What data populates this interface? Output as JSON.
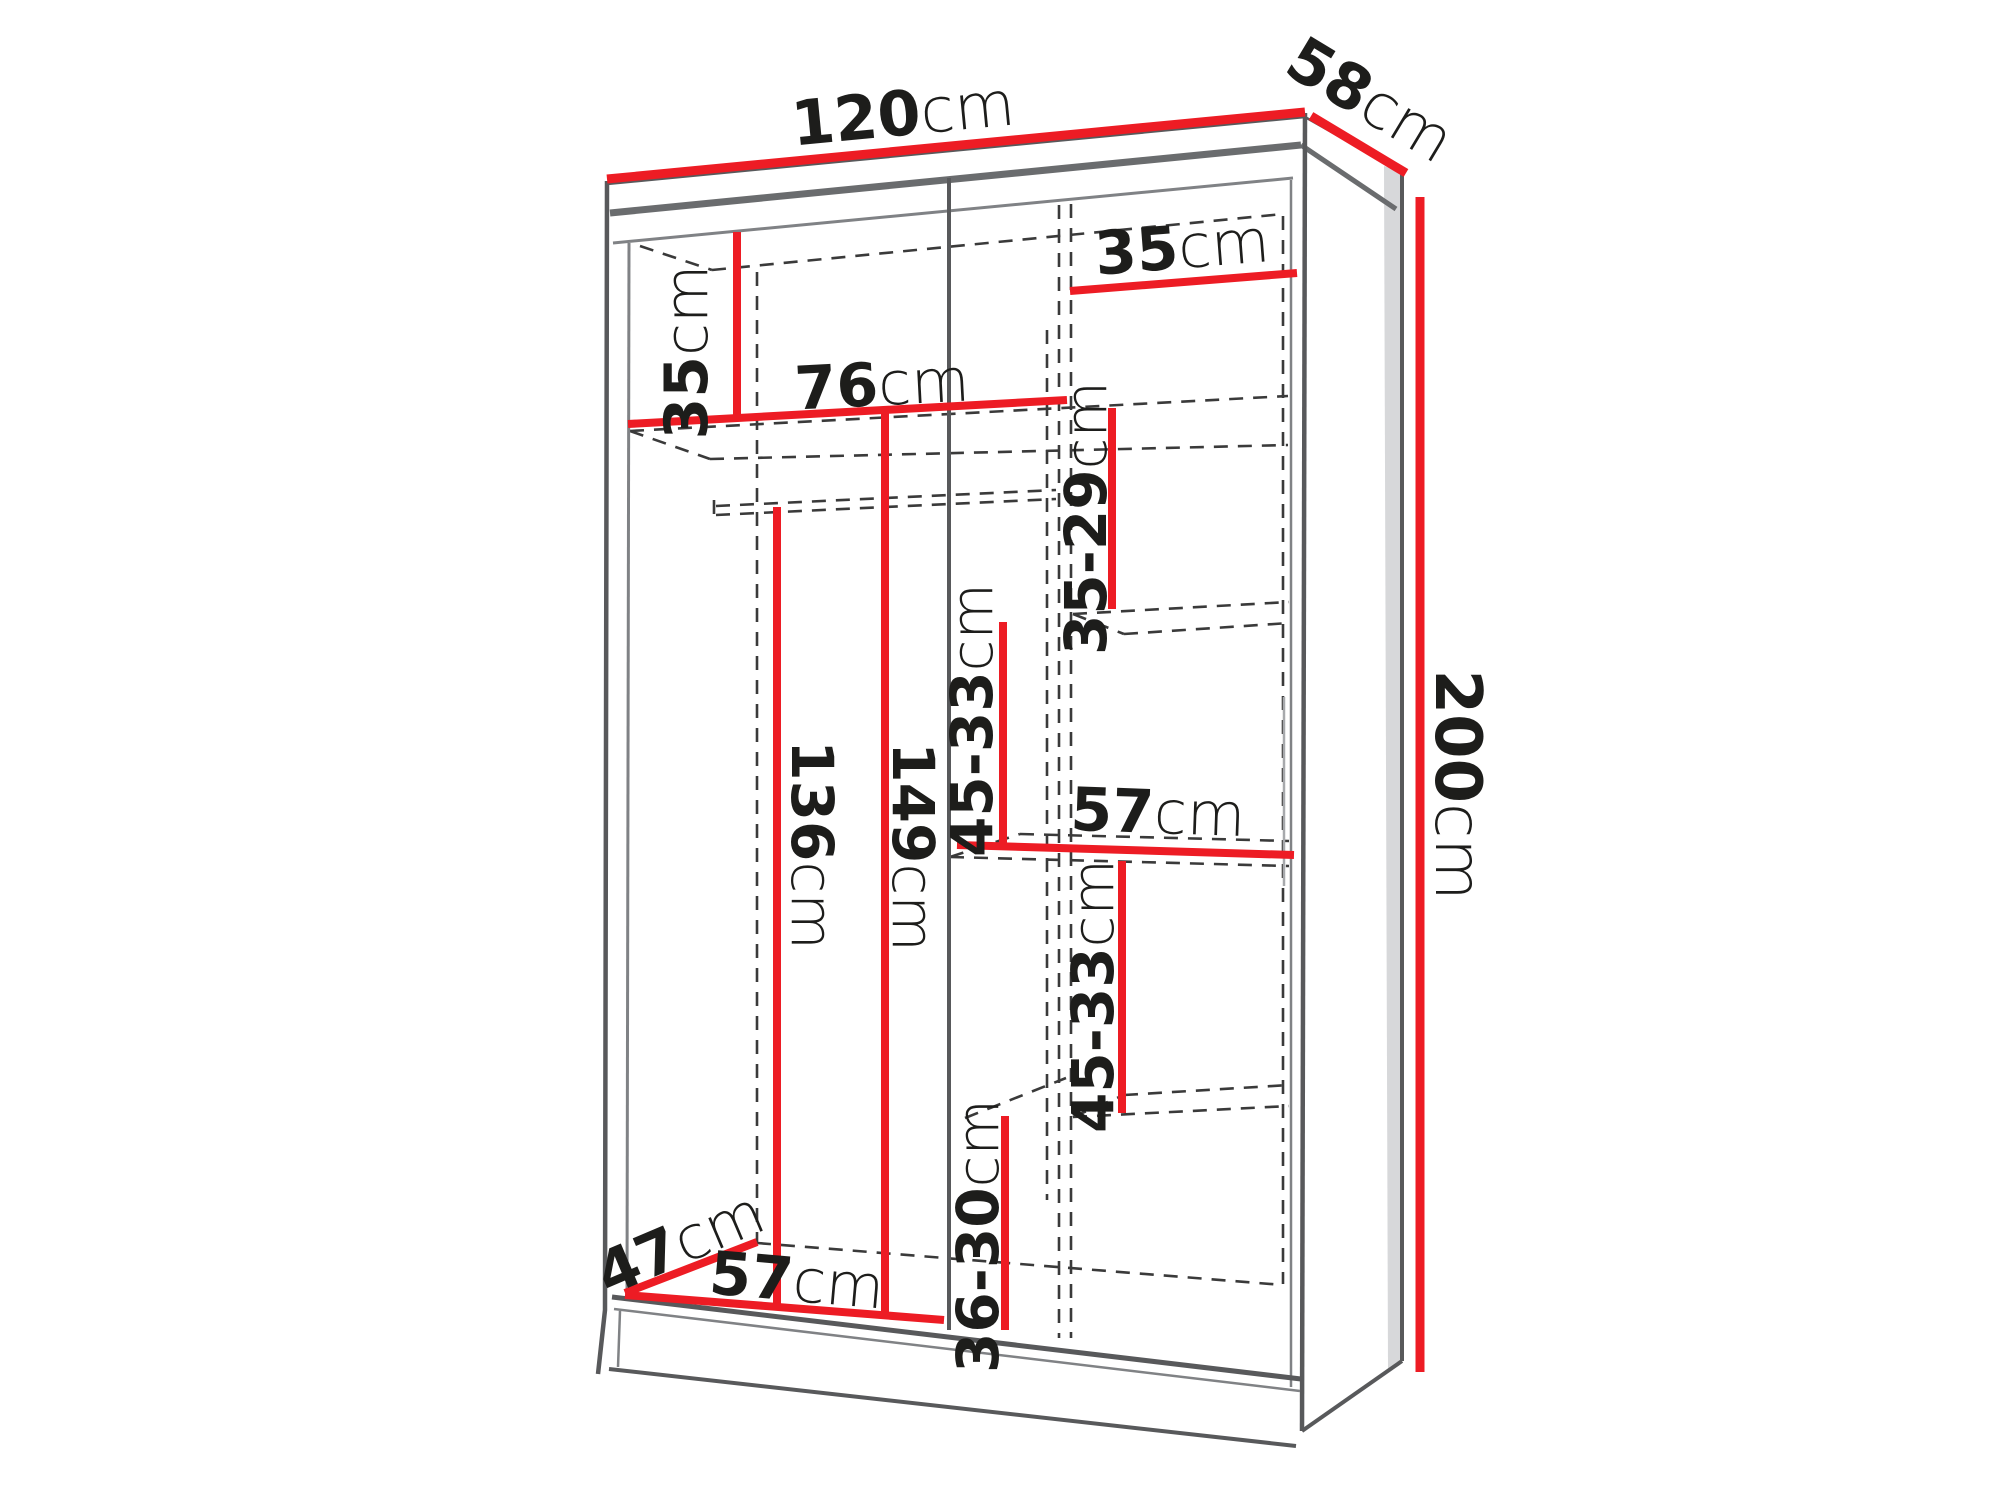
{
  "title": "wardrobe-interior-dimension-diagram",
  "colors": {
    "dimension_line_red": "#ed1c24",
    "outline_gray": "#58595b",
    "dashed_gray": "#3a3a3a",
    "label_black": "#1d1d1b",
    "background": "#ffffff"
  },
  "labels": {
    "width_top": {
      "num": "120",
      "unit": "cm"
    },
    "depth_top": {
      "num": "58",
      "unit": "cm"
    },
    "height_right": {
      "num": "200",
      "unit": "cm"
    },
    "top_section_left": {
      "num": "35",
      "unit": "cm"
    },
    "right_col_width": {
      "num": "35",
      "unit": "cm"
    },
    "left_width": {
      "num": "76",
      "unit": "cm"
    },
    "gap_1": {
      "num": "35-29",
      "unit": "cm"
    },
    "gap_2": {
      "num": "45-33",
      "unit": "cm"
    },
    "right_half_width": {
      "num": "57",
      "unit": "cm"
    },
    "gap_3": {
      "num": "45-33",
      "unit": "cm"
    },
    "gap_4": {
      "num": "36-30",
      "unit": "cm"
    },
    "hanging_height": {
      "num": "136",
      "unit": "cm"
    },
    "left_height": {
      "num": "149",
      "unit": "cm"
    },
    "floor_depth": {
      "num": "47",
      "unit": "cm"
    },
    "bottom_width": {
      "num": "57",
      "unit": "cm"
    }
  }
}
